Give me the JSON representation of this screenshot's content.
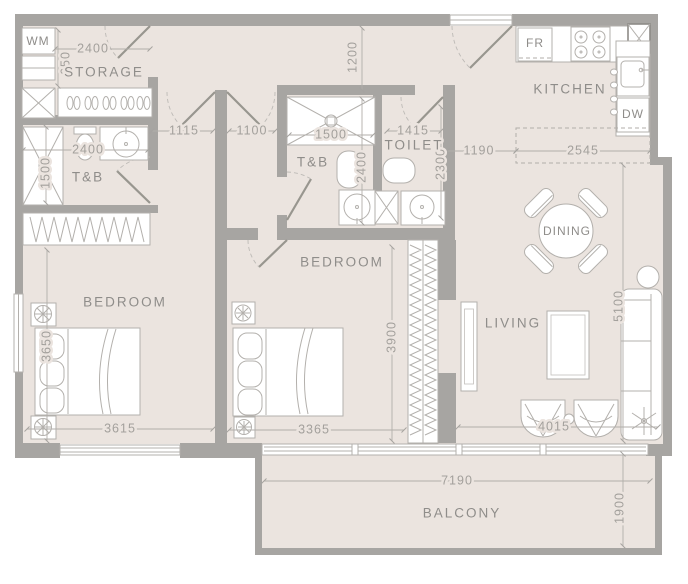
{
  "meta": {
    "type": "apartment floor plan",
    "units": "millimetres"
  },
  "colors": {
    "wall": "#a7a5a2",
    "floor": "#ebe4df",
    "fixture": "#ffffff",
    "line": "#b3b0ac",
    "label_text": "#8f8d8a",
    "dim_text": "#a3a09c"
  },
  "rooms": {
    "wm": "WM",
    "storage": "STORAGE",
    "tb1": "T&B",
    "tb2": "T&B",
    "toilet": "TOILET",
    "kitchen": "KITCHEN",
    "fr": "FR",
    "dw": "DW",
    "bedroom1": "BEDROOM",
    "bedroom2": "BEDROOM",
    "dining": "DINING",
    "living": "LIVING",
    "balcony": "BALCONY"
  },
  "dims": {
    "storage_width": "2400",
    "storage_depth": "650",
    "hall_width": "1200",
    "door_left": "1115",
    "door_right": "1100",
    "shower2_width": "1500",
    "toilet_width": "1415",
    "kitchen_pass": "1190",
    "counter_length": "2545",
    "tb1_width": "2400",
    "tb1_depth": "1500",
    "tb2_depth": "2400",
    "toilet_depth": "2300",
    "bedroom1_depth": "3650",
    "bedroom1_width": "3615",
    "bedroom2_depth": "3900",
    "bedroom2_width": "3365",
    "living_depth": "5100",
    "chairs_width": "4015",
    "balcony_width": "7190",
    "balcony_depth": "1900"
  }
}
